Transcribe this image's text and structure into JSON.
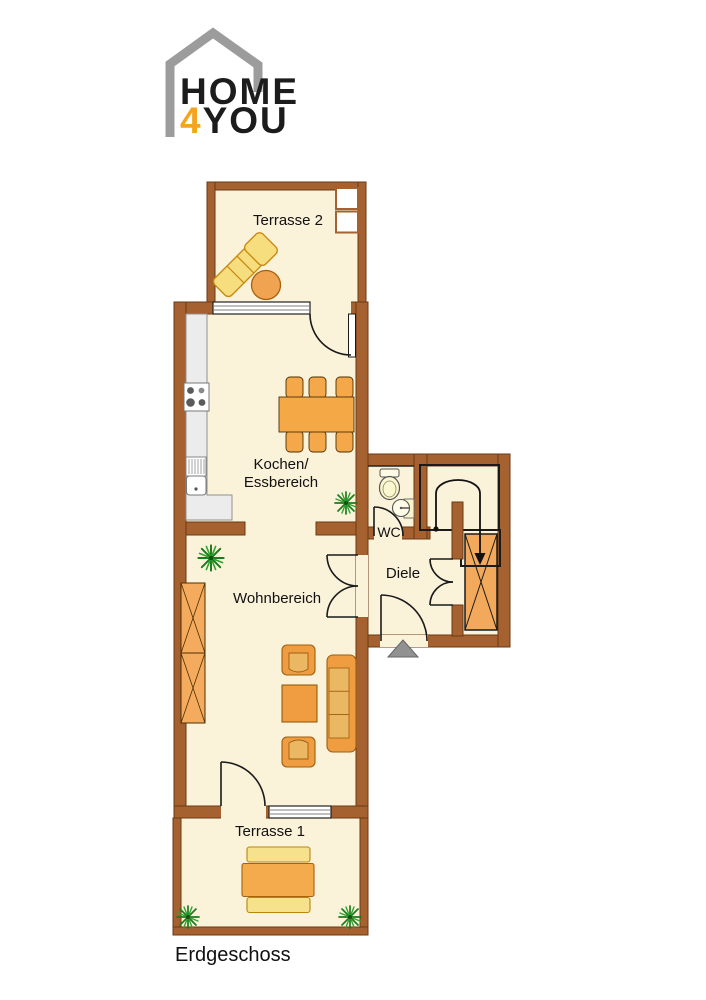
{
  "logo": {
    "word_top": "HOME",
    "accent_digit": "4",
    "word_bottom": "YOU"
  },
  "floor_label": "Erdgeschoss",
  "rooms": {
    "terrasse2": "Terrasse 2",
    "kochen_line1": "Kochen/",
    "kochen_line2": "Essbereich",
    "wc": "WC",
    "diele": "Diele",
    "wohnbereich": "Wohnbereich",
    "terrasse1": "Terrasse 1"
  },
  "colors": {
    "wall_brown": "#a5612f",
    "wall_outline": "#6b3a16",
    "floor_cream": "#fbf2da",
    "furniture_orange": "#f09c41",
    "cushion_light": "#eab763",
    "lounger_yellow": "#f6dd7d",
    "bench_yellow": "#f6e18c",
    "stair_orange": "#f3a95c",
    "counter_gray": "#ececec",
    "logo_gray": "#9c9c9c",
    "logo_accent": "#f5a41f",
    "plant_green": "#1e7a1c",
    "entrance_arrow_gray": "#919191"
  }
}
